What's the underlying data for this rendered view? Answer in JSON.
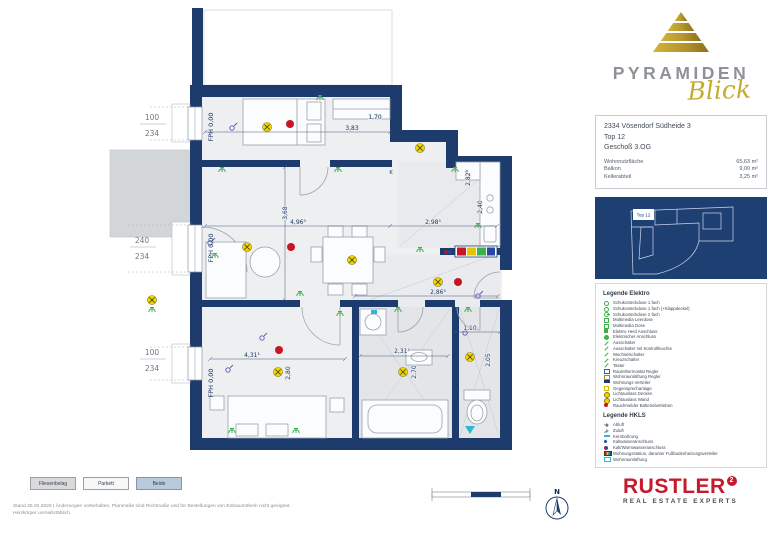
{
  "brand": {
    "name": "PYRAMIDEN",
    "sub": "Blick"
  },
  "info": {
    "address": "2334 Vösendorf Südheide 3",
    "unit": "Top 12",
    "floor": "Geschoß 3.OG",
    "rows": [
      {
        "label": "Wohnnutzfläche",
        "value": "65,63 m²"
      },
      {
        "label": "Balkon",
        "value": "9,00 m²"
      },
      {
        "label": "Kellerabteil",
        "value": "3,25 m²"
      }
    ]
  },
  "keyplan": {
    "highlight": "Top 12"
  },
  "legend_elektro": {
    "title": "Legende Elektro",
    "items": [
      {
        "icon": "outlet",
        "label": "Schukosteckdose 1 fach"
      },
      {
        "icon": "outlet",
        "label": "Schukosteckdose 1 fach (+Klappdeckel)"
      },
      {
        "icon": "outlet2",
        "label": "Schukosteckdose 2 fach"
      },
      {
        "icon": "media",
        "label": "Multimedia Leerdose"
      },
      {
        "icon": "media",
        "label": "Multimedia Dose"
      },
      {
        "icon": "herd",
        "label": "Elektro Herd Anschluss"
      },
      {
        "icon": "anschluss",
        "label": "Elektrischer Anschluss"
      },
      {
        "icon": "switch",
        "label": "Ausschalter"
      },
      {
        "icon": "switch",
        "label": "Ausschalter mit Kontrollleuchte"
      },
      {
        "icon": "switch",
        "label": "Wechselschalter"
      },
      {
        "icon": "switch",
        "label": "Kreuzschalter"
      },
      {
        "icon": "switch",
        "label": "Taster"
      },
      {
        "icon": "regler",
        "label": "Raumthermostat Regler"
      },
      {
        "icon": "regler2",
        "label": "Wohnraumlüftung Regler"
      },
      {
        "icon": "verteiler",
        "label": "Wohnungs Verteiler"
      },
      {
        "icon": "sprech",
        "label": "Gegensprechanlage"
      },
      {
        "icon": "light",
        "label": "Lichtauslass Decken"
      },
      {
        "icon": "light",
        "label": "Lichtauslass Wand"
      },
      {
        "icon": "rauch",
        "label": "Rauchmelder Batteriebetrieben"
      }
    ]
  },
  "legend_hkls": {
    "title": "Legende HKLS",
    "items": [
      {
        "icon": "abluft",
        "label": "Abluft"
      },
      {
        "icon": "zuluft",
        "label": "Zuluft"
      },
      {
        "icon": "kern",
        "label": "Kernbohrung"
      },
      {
        "icon": "kalt",
        "label": "Kaltwasseranschluss"
      },
      {
        "icon": "kaltwarm",
        "label": "Kalt/Warmwasseranschluss"
      },
      {
        "icon": "station",
        "label": "Wohnungsstation, darunter Fußbodenheizungsverteiler"
      },
      {
        "icon": "wrl",
        "label": "Wohnraumlüftung"
      }
    ]
  },
  "plan": {
    "fph": "FPH 0,00",
    "kitchen_label": "K",
    "window_labels": [
      {
        "w": "100",
        "h": "234"
      },
      {
        "w": "240",
        "h": "234"
      },
      {
        "w": "100",
        "h": "234"
      }
    ],
    "dims": {
      "top_width": "3,83",
      "top_niche": "1,70",
      "kitchen_h1": "2,82⁵",
      "kitchen_h2": "2,40",
      "living_h": "3,68",
      "living_w": "4,96⁵",
      "dining_w": "2,98⁵",
      "hall_w": "2,86⁵",
      "wc_w": "1,10",
      "wc_h": "2,05",
      "bedroom_w": "4,31¹",
      "bedroom_h": "2,80",
      "bath_w": "2,31⁵",
      "bath_h": "2,70"
    }
  },
  "toolbar": {
    "buttons": [
      "Fliesenbelag",
      "Parkett",
      "Beide"
    ]
  },
  "compass": {
    "north": "N"
  },
  "footer": {
    "line1": "Stand 25.02.2025 | Änderungen vorbehalten. Planmaße sind Richtmaße und für Bestellungen von Einbaumöbeln nicht geeignet.",
    "line2": "Heizkörper unmaßstäblich."
  },
  "rustler": {
    "name": "RUSTLER",
    "mark": "2",
    "tagline": "REAL ESTATE EXPERTS"
  },
  "colors": {
    "wall_navy": "#1d3c6d",
    "room_fill": "#edeff1",
    "balcony_gray": "#d3d6d9",
    "gold": "#b5952d",
    "brand_gray": "#8e9298",
    "rustler_red": "#c41a2b",
    "symbol_green": "#3db24b",
    "symbol_yellow": "#f2d600",
    "symbol_red": "#c81525",
    "symbol_purple": "#5a55c8",
    "symbol_cyan": "#2ab9d6"
  }
}
